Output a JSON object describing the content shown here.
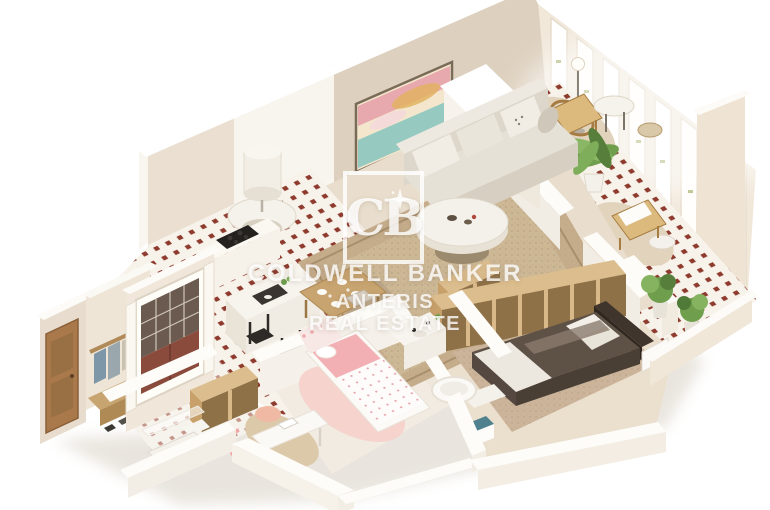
{
  "watermark": {
    "monogram": "CB",
    "line1": "COLDWELL BANKER",
    "line2": "ANTERIS",
    "line3": "REAL ESTATE",
    "color": "#ffffff"
  },
  "palette": {
    "background": "#ffffff",
    "wall_cream": "#ece1d2",
    "wall_beige": "#ddd0be",
    "wall_white": "#f7f3ec",
    "tile_red": "#8e3b2e",
    "tile_white": "#f7f2ea",
    "rug_beige": "#c5ad8c",
    "wood_light": "#c8a470",
    "plywood_top": "#dcbd8d",
    "plywood_inner": "#8f7148",
    "plant_green": "#6f9e4d",
    "bed_dark": "#5e5146",
    "kids_pink": "#f2b0b4",
    "rattan_tan": "#dcba7e",
    "door_oak": "#a9794b",
    "window_red_panel": "#8a4a3c"
  }
}
